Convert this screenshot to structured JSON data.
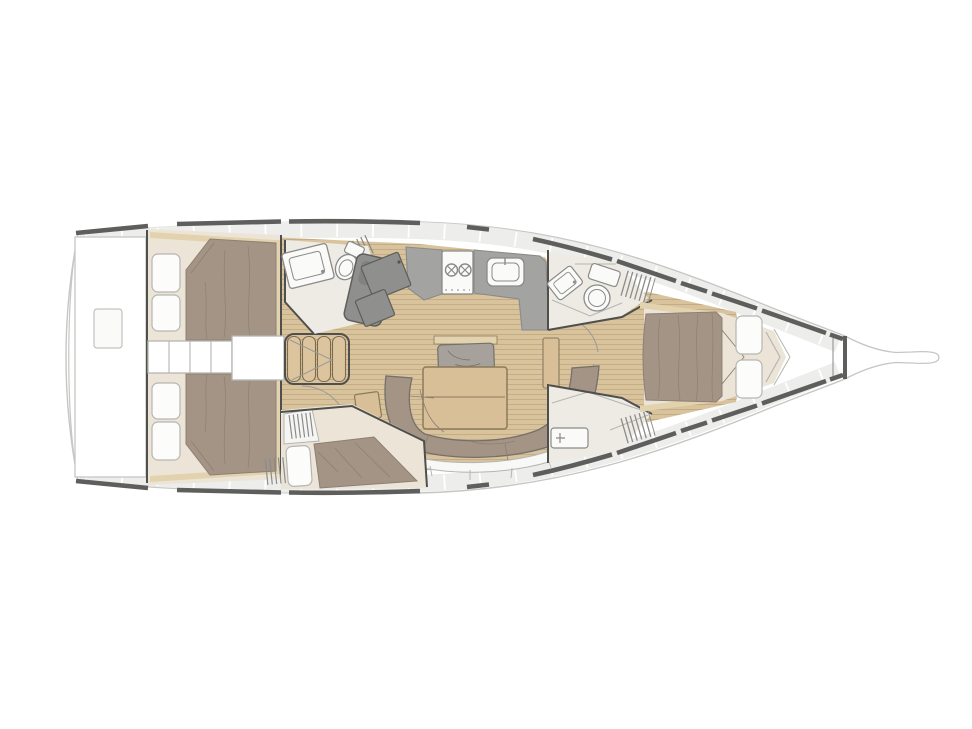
{
  "title": "Sailing yacht interior layout plan, top view, bow to the right",
  "orientation": {
    "bow": "right",
    "stern": "left"
  },
  "colors": {
    "background": "#ffffff",
    "white": "#ffffff",
    "hull_line": "#c6c6c4",
    "deck_band": "#ededeb",
    "deck_tick": "#ffffff",
    "deck_edge": "#5e5e5c",
    "wall": "#4f4f4d",
    "light_line": "#b5b5b3",
    "wood_floor": "#d8c39c",
    "wood_plank_line": "#c4ad84",
    "wood_trim": "#e2d2ae",
    "steps_wood": "#dcc49e",
    "steps_outline": "#7c6b4e",
    "room_floor": "#edebe3",
    "bed_base": "#ece5d7",
    "duvet": "#a39486",
    "duvet_line": "#8d7f73",
    "pillow": "#fcfcfb",
    "pillow_line": "#b5b5b3",
    "counter": "#a3a3a1",
    "counter_edge": "#6e6e6c",
    "module_dark": "#8f8f8d",
    "module_inner": "#82827f",
    "fixture_white": "#fafaf9",
    "fixture_line": "#8a8a88",
    "table_wood": "#d9bf98",
    "table_edge": "#8a7a5a",
    "cushion": "#a6a19b",
    "cushion_edge": "#75706a",
    "hatch_line": "#8b8b89",
    "arc_line": "#9a9a98"
  },
  "legend": [
    {
      "id": "stern-swim-platform"
    },
    {
      "id": "aft-cabin-port-double-bed"
    },
    {
      "id": "aft-cabin-starboard-double-bed"
    },
    {
      "id": "companionway-steps"
    },
    {
      "id": "aft-head-with-shower"
    },
    {
      "id": "galley-with-stove-and-sink"
    },
    {
      "id": "salon-table-and-sofa"
    },
    {
      "id": "single-berth-cabin"
    },
    {
      "id": "forward-head"
    },
    {
      "id": "forward-shower"
    },
    {
      "id": "forward-cabin-double-bed"
    },
    {
      "id": "bow-anchor-locker"
    },
    {
      "id": "bowsprit"
    }
  ]
}
